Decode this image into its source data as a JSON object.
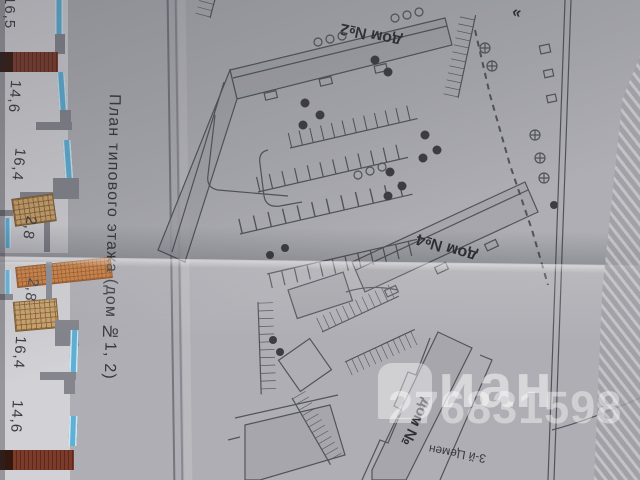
{
  "paper": {
    "caption_vertical": "План типового этажа (дом №1, 2)"
  },
  "floorplan": {
    "upper_rooms": [
      "16,5",
      "14,6",
      "16,4",
      "2,8"
    ],
    "lower_rooms": [
      "2,8",
      "16,4",
      "14,6"
    ]
  },
  "siteplan": {
    "building_top_label": "дом №2",
    "building_mid_label": "дом №4",
    "building_bottom_label": "дом №",
    "street_label": "3-й Цемен",
    "title_quote_mark": "»"
  },
  "watermark": {
    "brand_text": "иан",
    "listing_id": "276831598"
  },
  "colors": {
    "paper_gray": "#aeaeb4",
    "plan_line": "#53535b",
    "building_fill": "#a4a4aa",
    "window_blue": "#5fb0d6",
    "balcony_tan": "#c9a36b",
    "balcony_orange": "#c97a35",
    "loggia_dark_red": "#7c3a2a",
    "watermark_white": "rgba(255,255,255,0.5)"
  }
}
